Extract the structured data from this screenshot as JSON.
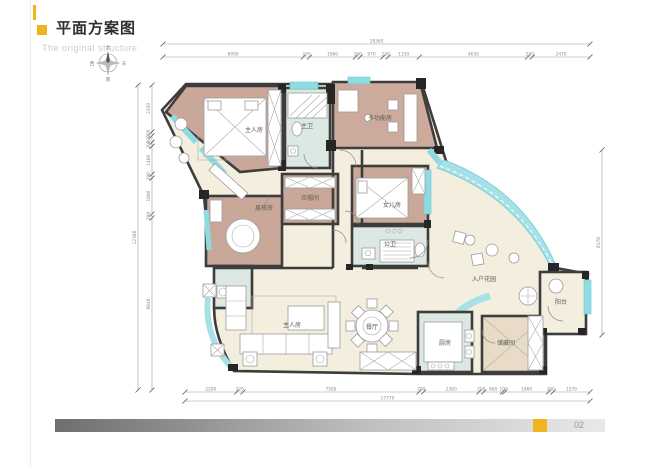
{
  "header": {
    "title": "平面方案图",
    "subtitle": "The original structure",
    "accent_color": "#f0b41e"
  },
  "compass": {
    "north": "北",
    "south": "南",
    "west": "西",
    "east": "东"
  },
  "rooms": {
    "master_bedroom": {
      "label": "主人房"
    },
    "master_bath": {
      "label": "主卫"
    },
    "multi_function": {
      "label": "多功能房"
    },
    "cloakroom": {
      "label": "衣帽间"
    },
    "boys_room": {
      "label": "男孩房"
    },
    "daughters_room": {
      "label": "女儿房"
    },
    "public_bath": {
      "label": "公卫"
    },
    "entry_garden": {
      "label": "入户花园"
    },
    "living_room": {
      "label": "主人房"
    },
    "dining_room": {
      "label": "餐厅"
    },
    "kitchen": {
      "label": "厨房"
    },
    "storage": {
      "label": "储藏间"
    },
    "balcony": {
      "label": "阳台"
    }
  },
  "dimensions": {
    "top_total": "18360",
    "top": [
      "6000",
      "270",
      "1960",
      "200",
      "970",
      "230",
      "1330",
      "4630",
      "200",
      "2470"
    ],
    "bottom_total": "17770",
    "bottom": [
      "2200",
      "270",
      "7500",
      "200",
      "2360",
      "200",
      "800",
      "100",
      "1860",
      "200",
      "1570"
    ],
    "left_total": "12380",
    "left": [
      "2350",
      "200",
      "330",
      "200",
      "1400",
      "200",
      "1800",
      "200",
      "8640"
    ],
    "right_total": "8370"
  },
  "footer": {
    "page_number": "02",
    "accent_color": "#f0b41e"
  },
  "colors": {
    "wall": "#3d3d3d",
    "window": "#8fdbe2",
    "bedroom_floor": "#c9a89a",
    "living_floor": "#f3eedd",
    "bath_floor": "#dce8e2",
    "storage_floor": "#e8dcc8",
    "accent": "#f0b41e"
  }
}
